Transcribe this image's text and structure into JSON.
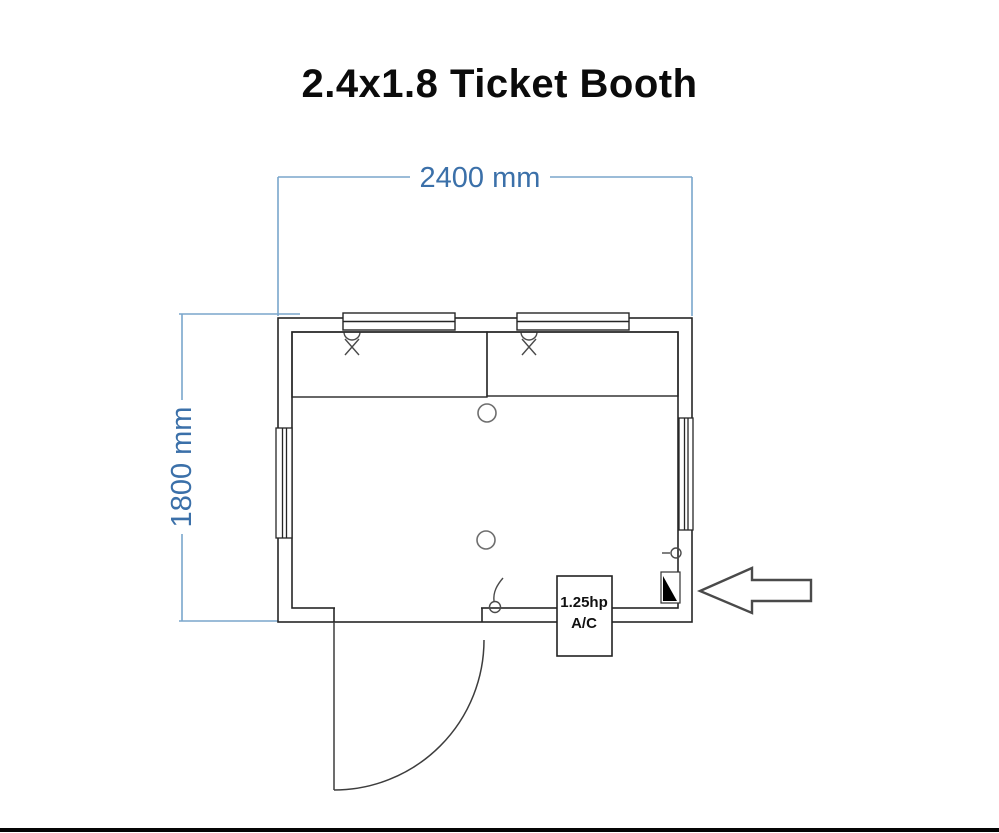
{
  "title": "2.4x1.8 Ticket Booth",
  "dimensions": {
    "width": {
      "label": "2400 mm"
    },
    "height": {
      "label": "1800 mm"
    }
  },
  "equipment": {
    "ac_unit": {
      "line1": "1.25hp",
      "line2": "A/C"
    }
  },
  "icons": {
    "entrance_arrow": "arrow-left-outline",
    "ceiling_light": "open-circle",
    "electrical_panel": "filled-black-triangle",
    "ticket_window_marker": "x-cross-with-arc",
    "door_handle": "circle-with-hook",
    "wall_switch": "circle-with-stem"
  },
  "colors": {
    "background": "#ffffff",
    "wall_line": "#262626",
    "dimension_line": "#7aa6cc",
    "dimension_text": "#3b70a9",
    "panel_fill": "#000000",
    "title_text": "#0b0b0b"
  }
}
